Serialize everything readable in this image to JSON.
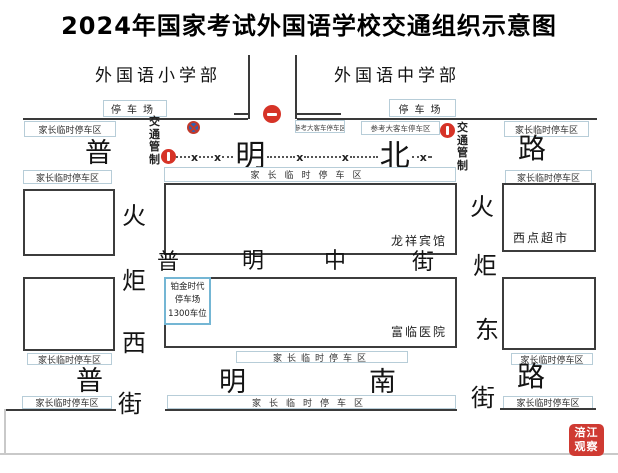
{
  "title": "2024年国家考试外国语学校交通组织示意图",
  "school": {
    "primary": "外国语小学部",
    "secondary": "外国语中学部",
    "parking_lot": "停车场"
  },
  "zones": {
    "parent_parking": "家长临时停车区",
    "bus_parking": "参考大客车停车区",
    "traffic_control": "交通管制"
  },
  "streets": {
    "puming_north_rd": {
      "chars": [
        "普",
        "明",
        "北",
        "路"
      ]
    },
    "puming_middle_st": {
      "chars": [
        "普",
        "明",
        "中",
        "街"
      ]
    },
    "puming_south_rd": {
      "chars": [
        "普",
        "明",
        "南",
        "路"
      ]
    },
    "huoju_west_st": {
      "chars": [
        "火",
        "炬",
        "西",
        "街"
      ]
    },
    "huoju_east_st": {
      "chars": [
        "火",
        "炬",
        "东",
        "街"
      ]
    }
  },
  "pois": {
    "hotel": "龙祥宾馆",
    "hospital": "富临医院",
    "supermarket": "西点超市",
    "platinum_parking": {
      "line1": "铂金时代",
      "line2": "停车场",
      "line3": "1300车位"
    }
  },
  "signs": {
    "closure_x": "x"
  },
  "watermark": {
    "line1": "涪江",
    "line2": "观察"
  },
  "colors": {
    "sign_red": "#d63327",
    "no_parking_blue": "#2a62b8",
    "platinum_border": "#74b6d4",
    "watermark_red": "#cf3a32"
  }
}
